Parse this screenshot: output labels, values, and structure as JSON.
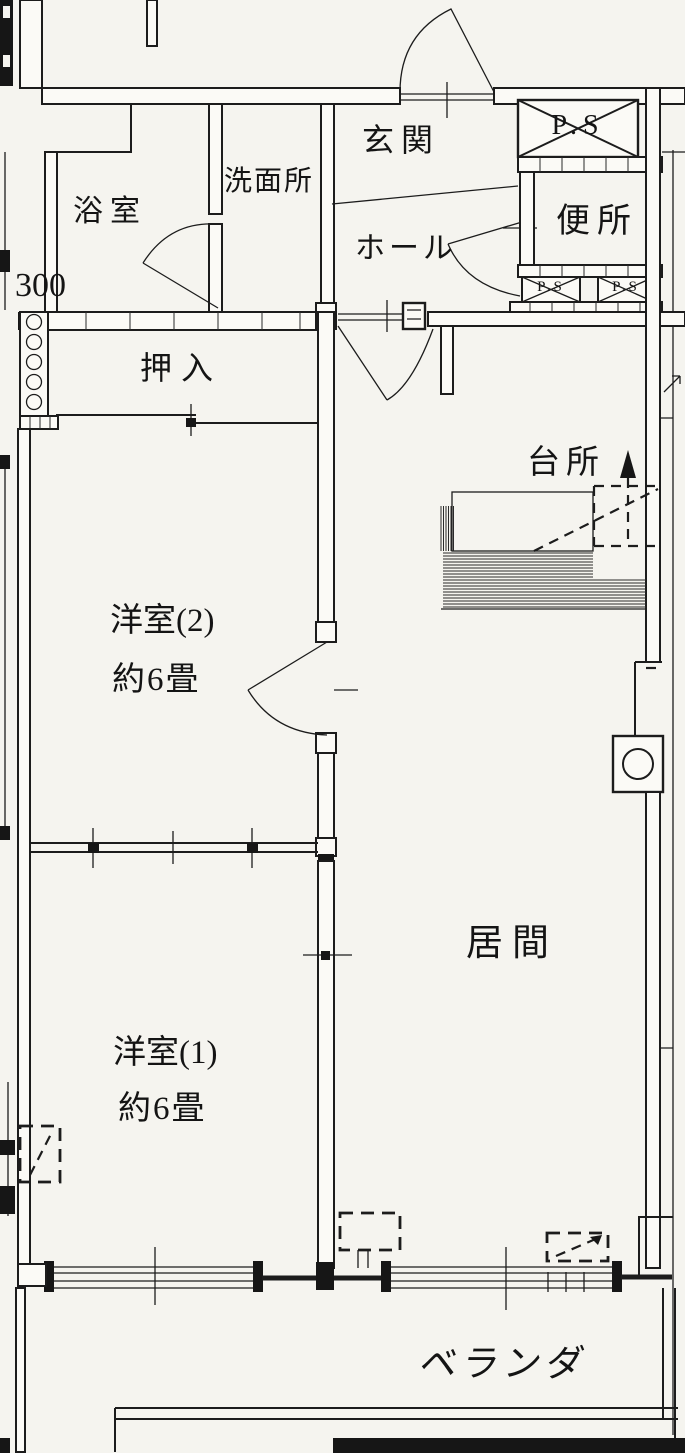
{
  "floor_plan": {
    "rooms": {
      "bath": "浴室",
      "washroom": "洗面所",
      "entrance": "玄関",
      "hall": "ホール",
      "toilet": "便所",
      "closet": "押入",
      "kitchen": "台所",
      "western_room_2": "洋室(2)",
      "western_room_2_size": "約6畳",
      "western_room_1": "洋室(1)",
      "western_room_1_size": "約6畳",
      "living_room": "居間",
      "veranda": "ベランダ"
    },
    "annotations": {
      "pipe_space_top": "P.S",
      "pipe_space_left": "P.S",
      "pipe_space_right": "P.S",
      "dimension_300": "300"
    },
    "colors": {
      "line": "#1c1c1c",
      "paper": "#f5f4ef"
    }
  }
}
